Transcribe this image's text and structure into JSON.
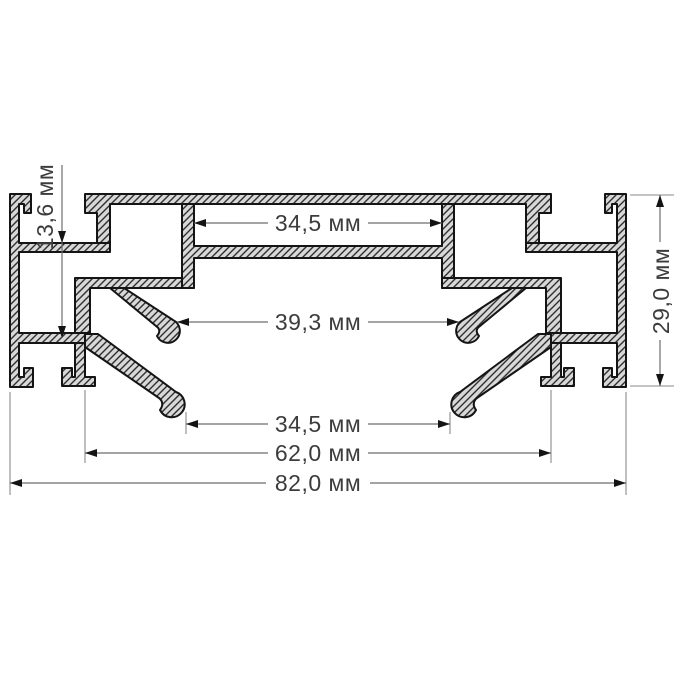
{
  "drawing": {
    "object": "aluminium-profile-cross-section",
    "unit": "мм",
    "dimensions": {
      "slot_depth": {
        "label": "13,6 мм",
        "value": 13.6
      },
      "top_channel_width": {
        "label": "34,5 мм",
        "value": 34.5
      },
      "hook_span": {
        "label": "39,3 мм",
        "value": 39.3
      },
      "flange_tip_span": {
        "label": "34,5 мм",
        "value": 34.5
      },
      "inner_width": {
        "label": "62,0 мм",
        "value": 62.0
      },
      "overall_width": {
        "label": "82,0 мм",
        "value": 82.0
      },
      "overall_height": {
        "label": "29,0 мм",
        "value": 29.0
      }
    },
    "colors": {
      "metal_fill": "#d8d8d8",
      "outline": "#141414",
      "hatch": "#2e2e2e",
      "dimension_line": "#6e6e6e",
      "text": "#3c3c3c",
      "background": "#ffffff"
    }
  }
}
